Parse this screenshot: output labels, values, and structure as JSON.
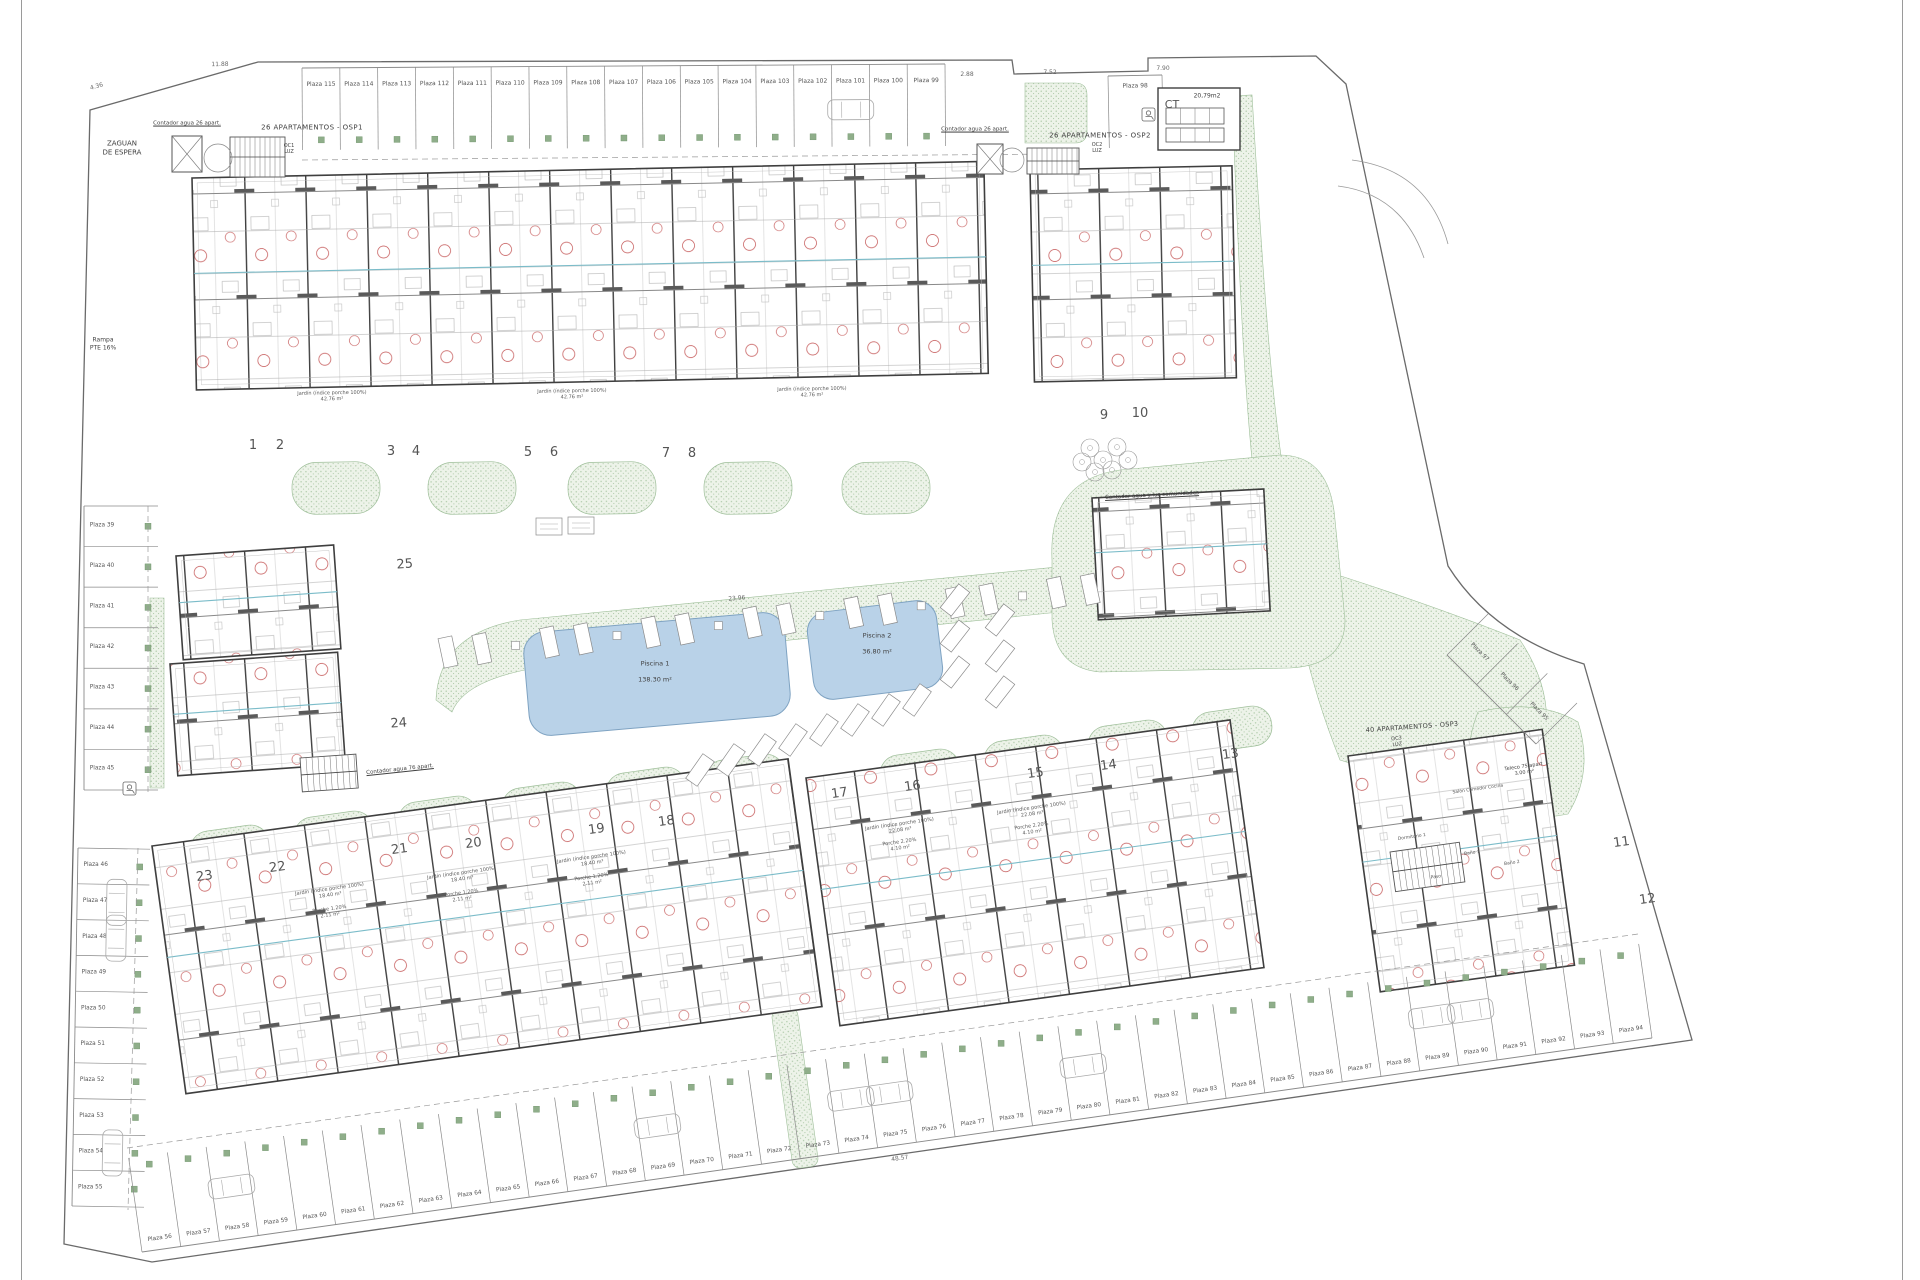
{
  "page": {
    "background": "#ffffff"
  },
  "colors": {
    "pool_fill": "#b9d2e8",
    "pool_stroke": "#7fa3c2",
    "green_fill": "#edf3e9",
    "green_dot": "#a9c6a4",
    "green_stroke": "#9fbf9a",
    "wall": "#3f3f3f",
    "line": "#8a8a8a",
    "light_line": "#b5b5b5",
    "red": "#c25050",
    "teal": "#7bbcc9",
    "text": "#4a4a4a",
    "dim_text": "#6a6a6a"
  },
  "labels": {
    "zaguan": "ZAGUAN\nDE ESPERA",
    "rampa": "Rampa\nPTE 16%",
    "contador_osp1": "Contador agua 26 apart.",
    "contador_osp2": "Contador agua 26 apart.",
    "contador_76": "Contador agua 76 apart.",
    "contador_comunidades": "Contador agua y luz comunidades",
    "block_osp1": "26 APARTAMENTOS - OSP1",
    "block_osp2": "26 APARTAMENTOS - OSP2",
    "block_osp3": "40 APARTAMENTOS - OSP3",
    "oc1": "OC1\nLUZ",
    "oc2": "OC2\nLUZ",
    "oc3": "OC3\nLUZ",
    "telecos": "Teleco 75 apart\n3.00 m²",
    "ct": "CT",
    "ct_area": "20,79m2"
  },
  "pools": [
    {
      "name": "Piscina 1",
      "area": "138.30 m²"
    },
    {
      "name": "Piscina 2",
      "area": "36.80 m²"
    }
  ],
  "plots": [
    "1",
    "2",
    "3",
    "4",
    "5",
    "6",
    "7",
    "8",
    "9",
    "10",
    "11",
    "12",
    "13",
    "14",
    "15",
    "16",
    "17",
    "18",
    "19",
    "20",
    "21",
    "22",
    "23",
    "24",
    "25"
  ],
  "parking": {
    "top": [
      "Plaza 115",
      "Plaza 114",
      "Plaza 113",
      "Plaza 112",
      "Plaza 111",
      "Plaza 110",
      "Plaza 109",
      "Plaza 108",
      "Plaza 107",
      "Plaza 106",
      "Plaza 105",
      "Plaza 104",
      "Plaza 103",
      "Plaza 102",
      "Plaza 101",
      "Plaza 100",
      "Plaza 99"
    ],
    "top_right": "Plaza 98",
    "right_diagonal": [
      "Plaza 97",
      "Plaza 96",
      "Plaza 95"
    ],
    "left_upper": [
      "Plaza 39",
      "Plaza 40",
      "Plaza 41",
      "Plaza 42",
      "Plaza 43",
      "Plaza 44",
      "Plaza 45"
    ],
    "left_lower": [
      "Plaza 46",
      "Plaza 47",
      "Plaza 48",
      "Plaza 49",
      "Plaza 50",
      "Plaza 51",
      "Plaza 52",
      "Plaza 53",
      "Plaza 54",
      "Plaza 55"
    ],
    "bottom": [
      "Plaza 56",
      "Plaza 57",
      "Plaza 58",
      "Plaza 59",
      "Plaza 60",
      "Plaza 61",
      "Plaza 62",
      "Plaza 63",
      "Plaza 64",
      "Plaza 65",
      "Plaza 66",
      "Plaza 67",
      "Plaza 68",
      "Plaza 69",
      "Plaza 70",
      "Plaza 71",
      "Plaza 72",
      "Plaza 73",
      "Plaza 74",
      "Plaza 75",
      "Plaza 76",
      "Plaza 77",
      "Plaza 78",
      "Plaza 79",
      "Plaza 80",
      "Plaza 81",
      "Plaza 82",
      "Plaza 83",
      "Plaza 84",
      "Plaza 85",
      "Plaza 86",
      "Plaza 87",
      "Plaza 88",
      "Plaza 89",
      "Plaza 90",
      "Plaza 91",
      "Plaza 92",
      "Plaza 93",
      "Plaza 94"
    ]
  },
  "unit_labels": {
    "jardin_top": "Jardín (índice porche 100%)\n42.76 m²",
    "jardin_row": "Jardín (índice porche 100%)\n18.40 m²",
    "porche_row": "Porche 1.20%\n2.11 m²",
    "jardin_mid": "Jardín (índice porche 100%)\n22.08 m²",
    "porche_mid": "Porche 2.20%\n4.10 m²"
  },
  "rooms": [
    "Salón Comedor Cocina",
    "Dormitorio 1",
    "Baño 1",
    "Baño 2",
    "Paso"
  ],
  "dimensions": {
    "top_left": "11.88",
    "corner": "4.36",
    "ct_left": "2.88",
    "ct_right": "7.52",
    "ne_edge": "7.90",
    "pool_deck": "23.96",
    "bottom_row": "48.57"
  }
}
